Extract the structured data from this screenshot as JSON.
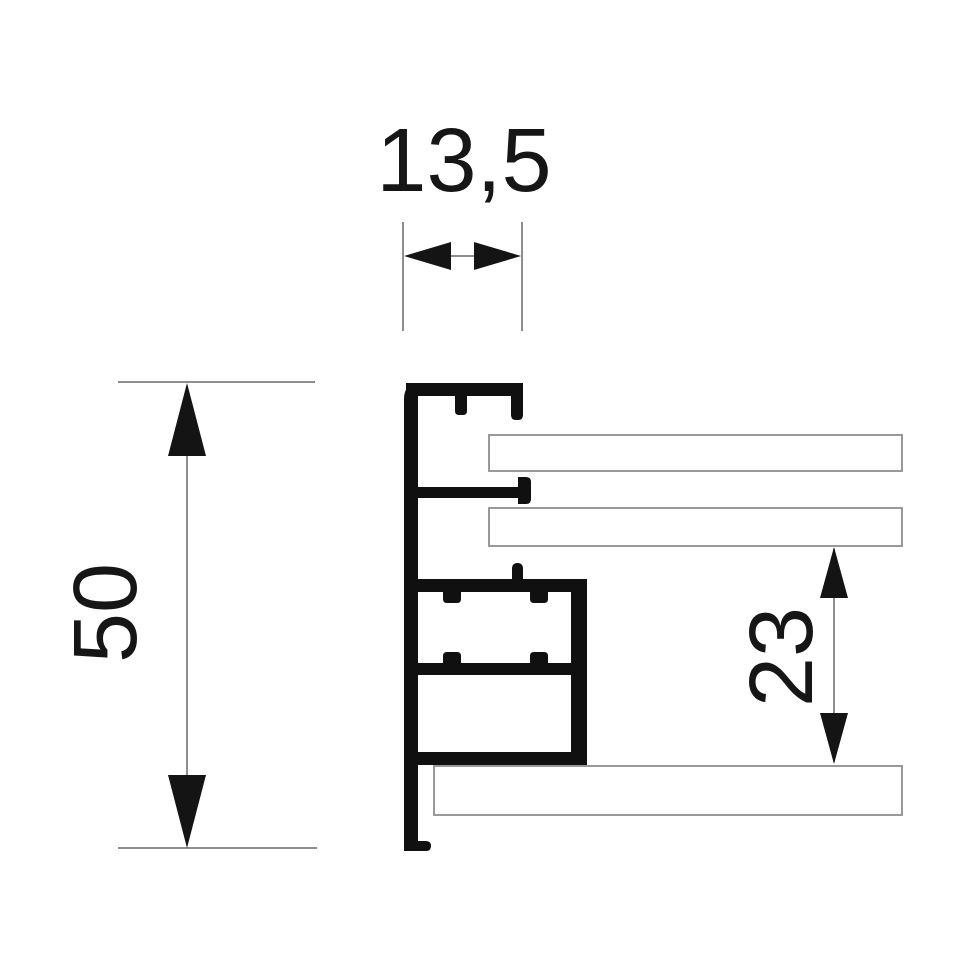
{
  "drawing": {
    "dimensions": {
      "top_width_mm": "13,5",
      "left_height_mm": "50",
      "right_height_mm": "23"
    },
    "colors": {
      "profile_fill": "#101010",
      "dimension_line": "#8e8e8e",
      "panel_stroke": "#8e8e8e",
      "text": "#161616",
      "background": "#ffffff"
    }
  }
}
